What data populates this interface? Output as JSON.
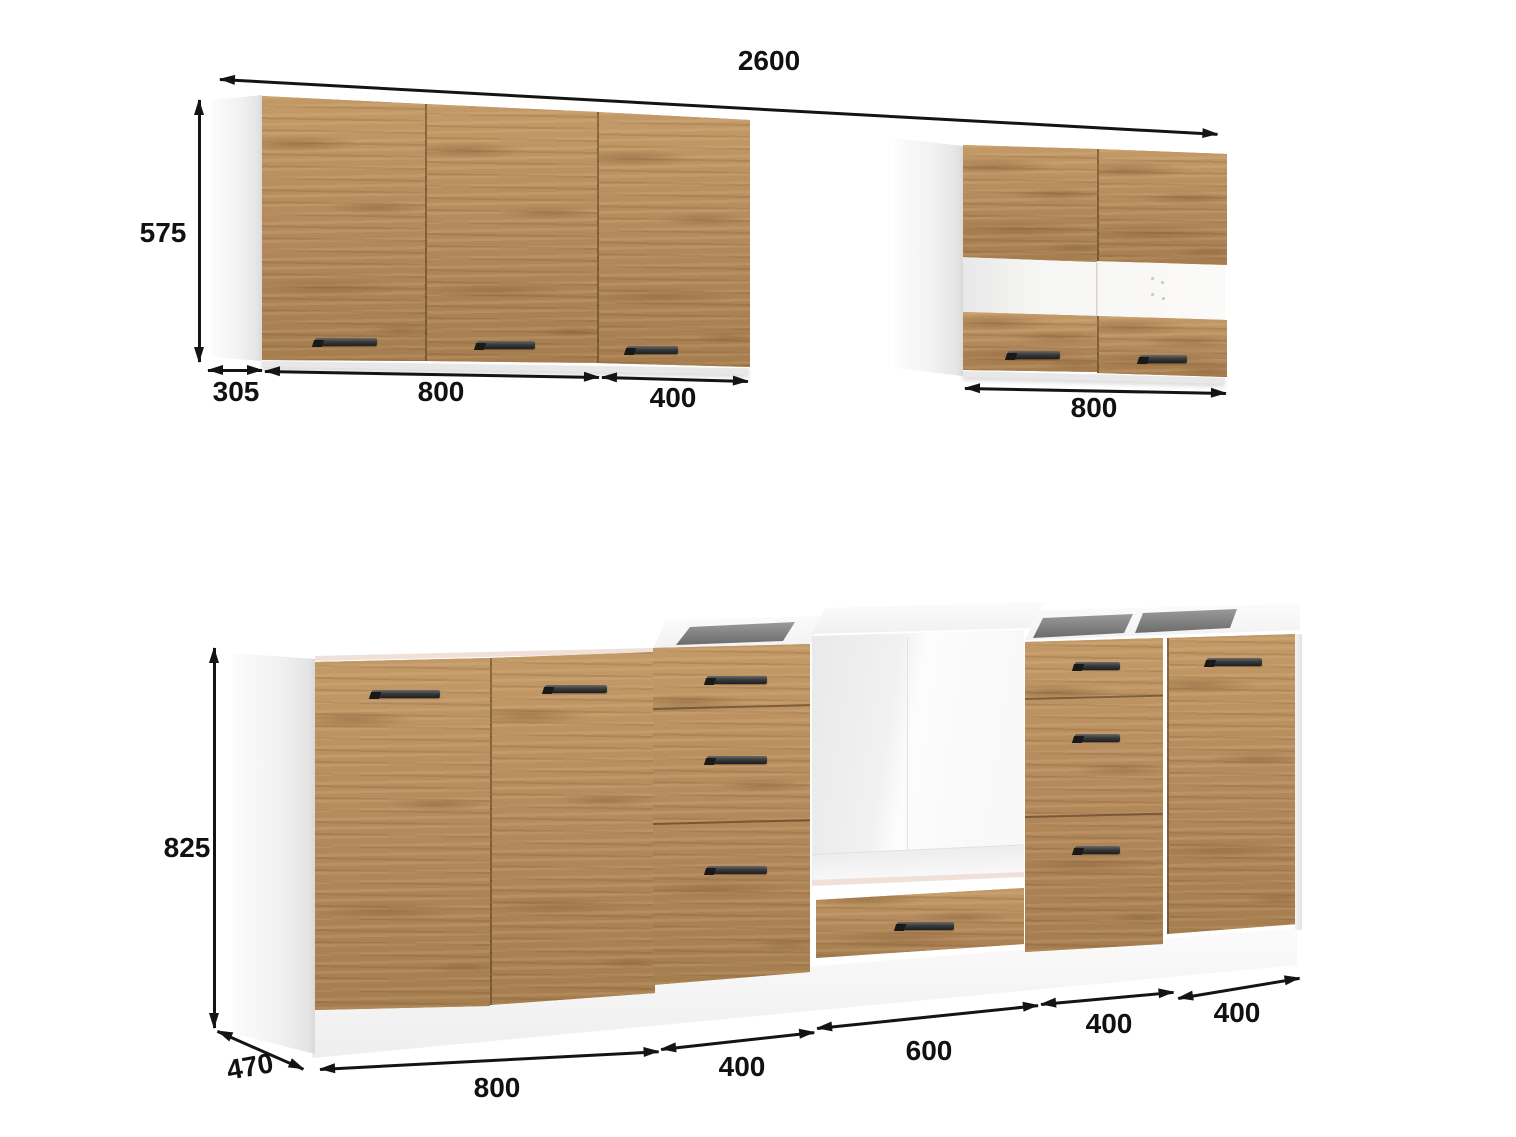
{
  "wall_cabinets": {
    "total_width": "2600",
    "left": {
      "height": "575",
      "depth": "305",
      "segment_widths": [
        "800",
        "400"
      ],
      "door_count": 3
    },
    "right": {
      "width": "800"
    }
  },
  "base_cabinets": {
    "height": "825",
    "depth": "470",
    "segment_widths": [
      "800",
      "400",
      "600",
      "400",
      "400"
    ]
  },
  "colors": {
    "wood": "#b78c59",
    "carcass_white": "#f4f4f4",
    "counter_edge": "#efe1d7",
    "handle": "#2e2e2e",
    "dimension_ink": "#141414",
    "hob_recess": "#7a7a7a",
    "background": "#ffffff"
  }
}
